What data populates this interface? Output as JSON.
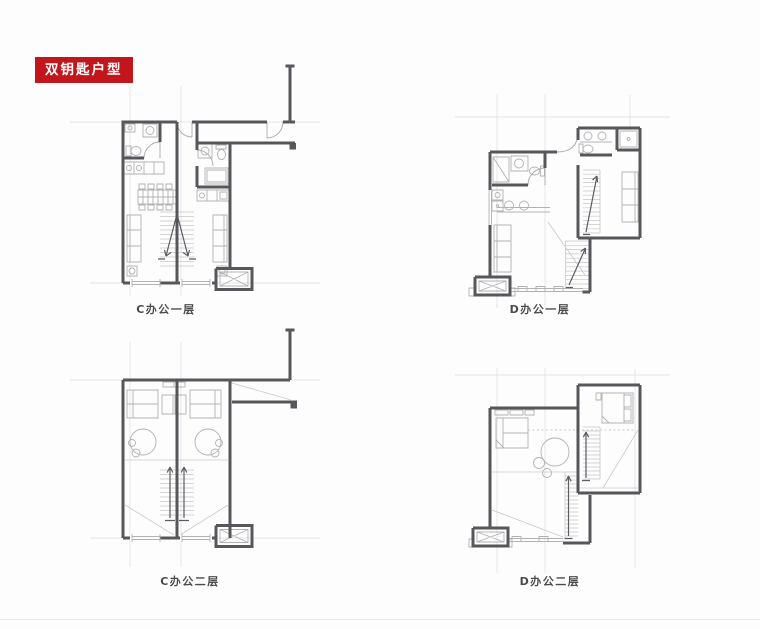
{
  "badge": {
    "label": "双钥匙户型",
    "bg": "#c3161c",
    "fg": "#ffffff"
  },
  "plans": [
    {
      "label": "C办公一层"
    },
    {
      "label": "D办公一层"
    },
    {
      "label": "C办公二层"
    },
    {
      "label": "D办公二层"
    }
  ],
  "colors": {
    "accent_red": "#c3161c",
    "wall_gray": "#57575b",
    "fixture_gray": "#b2b2b4",
    "grid_gray": "#dcdcdc",
    "background": "#fdfdfd"
  }
}
